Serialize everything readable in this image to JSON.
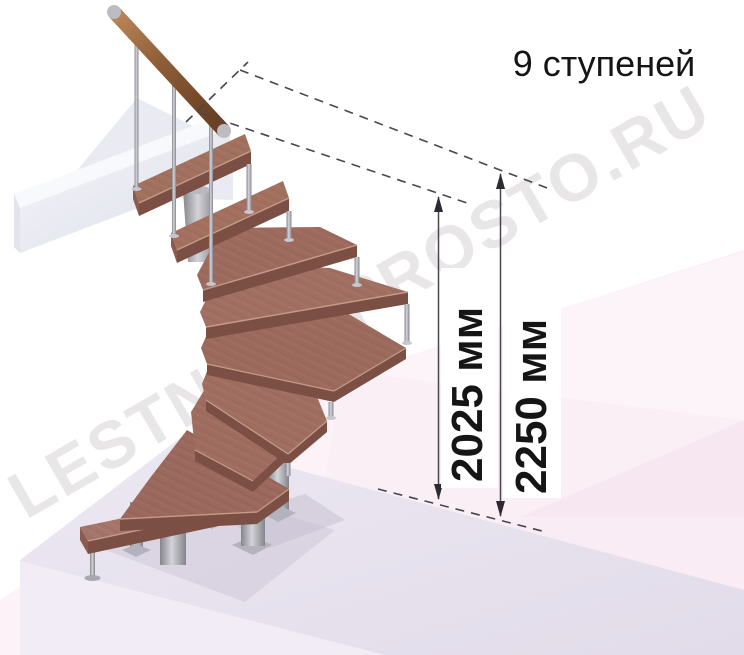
{
  "title": {
    "text": "9 ступеней"
  },
  "watermark": {
    "text": "LESTNICA-PROSTO.RU"
  },
  "dimensions": {
    "dim_2025": {
      "label": "2025 мм"
    },
    "dim_2250": {
      "label": "2250 мм"
    }
  },
  "scene": {
    "description": "3D render of a modular winder staircase with central column, 9 wooden steps, metal balusters and wooden handrail, standing on a floor slab below an upper landing beam",
    "steps_count": 9,
    "colors": {
      "wood_step_top": "#9e6c5f",
      "wood_step_front": "#7c4f45",
      "handrail_wood": "#9a6a44",
      "metal": "#a9a9b0",
      "floor_slab": "#e8e3ee",
      "upper_beam": "#eceef5",
      "background_pink": "#fbeef6",
      "annotation_line": "#4a454f",
      "text": "#151515"
    }
  }
}
